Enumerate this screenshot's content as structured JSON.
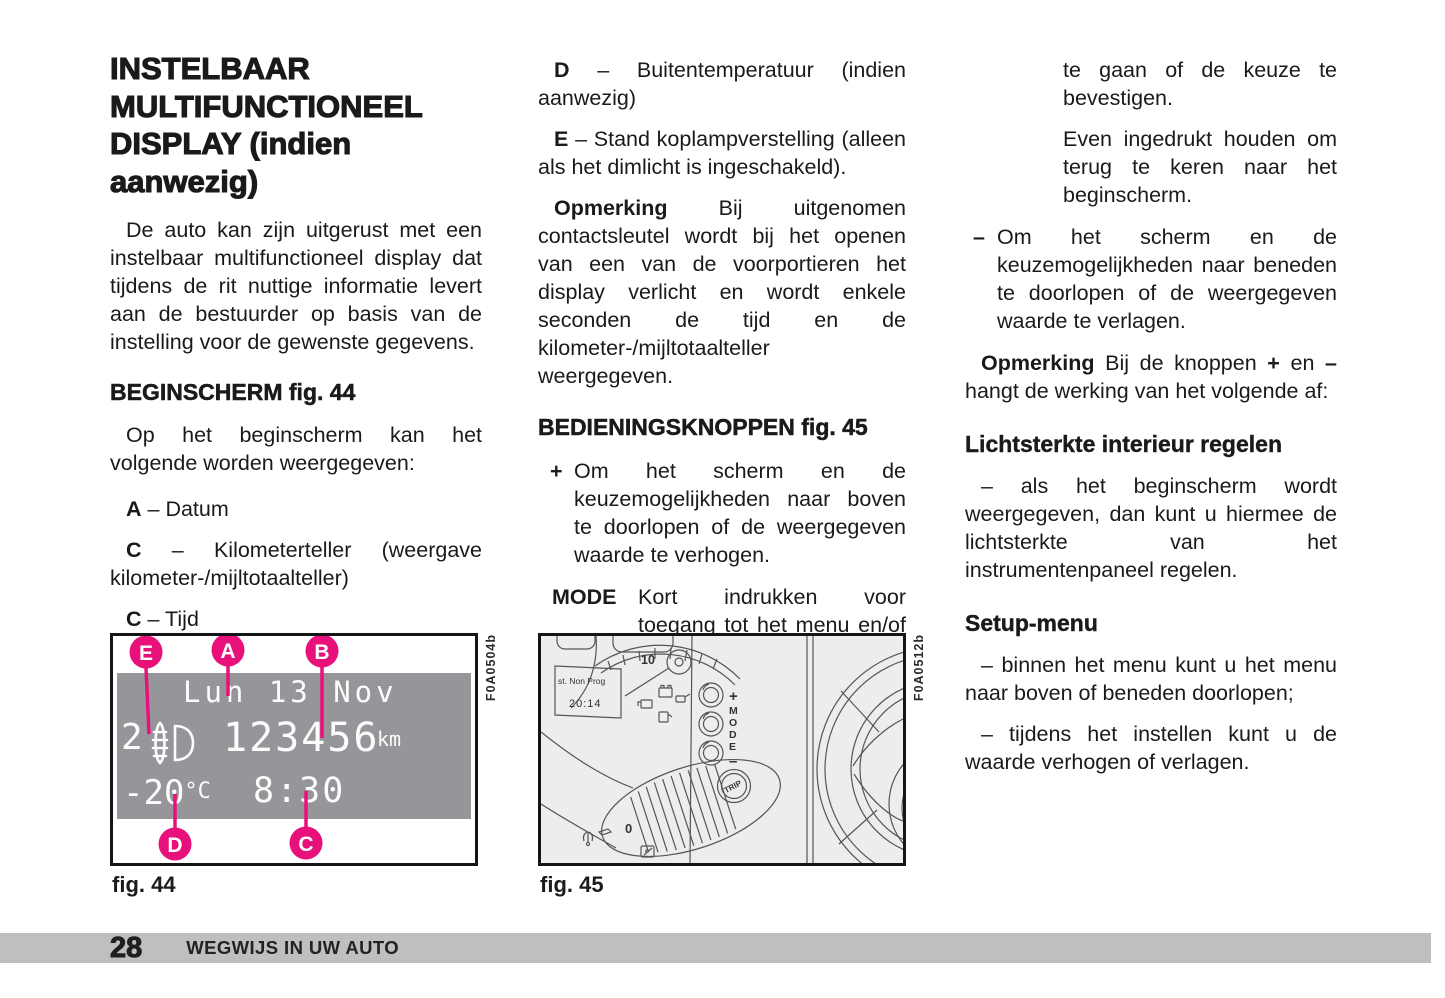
{
  "colors": {
    "callout_pink": "#e8117c",
    "lcd_gray": "#96969a",
    "fig45_bg": "#ededee",
    "footer_bar": "#bebfc1"
  },
  "glue": {
    "dash_sep": "– "
  },
  "left": {
    "title": "INSTELBAAR MULTIFUNCTIONEEL DISPLAY (indien aanwezig)",
    "intro": "De auto kan zijn uitgerust met een instelbaar multifunctioneel display dat tijdens de rit nuttige informatie levert aan de bestuurder op basis van de instelling voor de gewenste gegevens.",
    "heading": "BEGINSCHERM fig. 44",
    "intro2": "Op het beginscherm kan het volgende worden weergegeven:",
    "items": [
      {
        "label": "A",
        "text": "– Datum"
      },
      {
        "label": "C",
        "text": "– Kilometerteller (weergave kilometer-/mijltotaalteller)"
      },
      {
        "label": "C",
        "text": "– Tijd"
      }
    ]
  },
  "middle": {
    "items": [
      {
        "label": "D",
        "text": "– Buitentemperatuur (indien aanwezig)"
      },
      {
        "label": "E",
        "text": "– Stand koplampverstelling (alleen als het dimlicht is ingeschakeld)."
      }
    ],
    "note_lead": "Opmerking",
    "note_text": " Bij uitgenomen contactsleutel wordt bij het openen van een van de voorportieren het display verlicht en wordt enkele seconden de tijd en de kilometer-/mijltotaalteller weergegeven.",
    "heading": "BEDIENINGSKNOPPEN fig. 45",
    "plus_label": "+",
    "plus_text": "Om het scherm en de keuzemogelijkheden naar boven te doorlopen of de weergegeven waarde te verhogen.",
    "mode_label": "MODE",
    "mode_text": "Kort indrukken voor toegang tot het menu en/of naar het volgende scherm"
  },
  "right": {
    "cont1": "te gaan of de keuze te bevestigen.",
    "cont2": "Even ingedrukt houden om terug te keren naar het beginscherm.",
    "minus_label": "–",
    "minus_text": "Om het scherm en de keuzemogelijkheden naar beneden te doorlopen of de weergegeven waarde te verlagen.",
    "note_lead": "Opmerking",
    "note_a": " Bij de knoppen ",
    "note_plus": "+",
    "note_b": " en ",
    "note_minus": "–",
    "note_c": " hangt de werking van het volgende af:",
    "sub1": "Lichtsterkte interieur regelen",
    "sub1_text": "– als het beginscherm wordt weergegeven, dan kunt u hiermee de lichtsterkte van het instrumentenpaneel regelen.",
    "sub2": "Setup-menu",
    "sub2_text1": "– binnen het menu kunt u het menu naar boven of beneden doorlopen;",
    "sub2_text2": "– tijdens het instellen kunt u de waarde verhogen of verlagen."
  },
  "fig44": {
    "caption": "fig. 44",
    "code": "F0A0504b",
    "display": {
      "date": "Lun 13 Nov",
      "level": "2",
      "odometer": "123456",
      "odometer_unit": "km",
      "temperature": "-20",
      "temperature_unit": "°C",
      "time": "8:30"
    },
    "callouts": [
      "E",
      "A",
      "B",
      "D",
      "C"
    ]
  },
  "fig45": {
    "caption": "fig. 45",
    "code": "F0A0512b",
    "display_line1": "st. Non Prog",
    "display_line2": "20:14",
    "tach_label": "10",
    "plus": "+",
    "mode_letters": [
      "M",
      "O",
      "D",
      "E"
    ],
    "minus": "–",
    "trip": "TRIP",
    "zero": "0"
  },
  "footer": {
    "page_number": "28",
    "section": "WEGWIJS IN UW AUTO"
  }
}
